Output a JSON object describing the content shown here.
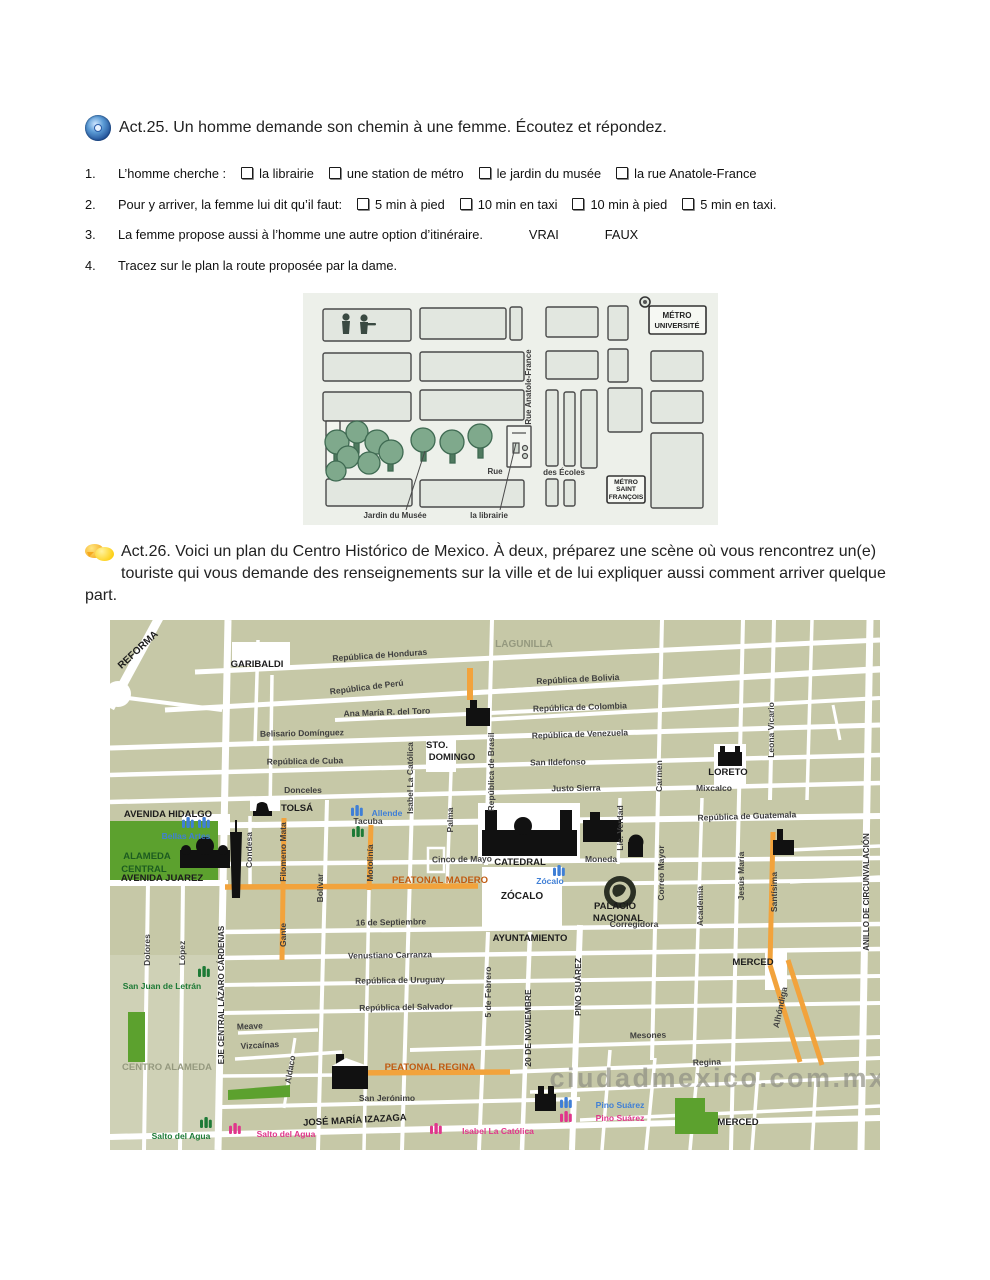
{
  "colors": {
    "map_bg": "#c6c8a7",
    "map_bg_light": "#cfd1b6",
    "street_white": "#ffffff",
    "orange_street": "#f2a33c",
    "park_green": "#5ca12e",
    "metro_blue": "#3f7fd6",
    "metro_pink": "#e0368c",
    "metro_green": "#1d7a36",
    "peatonal_label": "#c05a10",
    "watermark_grey": "#8f9084",
    "small_map_bg": "#edf0ea",
    "accent_cd_blue": "#2a5ca8",
    "accent_bubble_yellow": "#f5a81e"
  },
  "act25": {
    "icon": "audio-cd-icon",
    "title": "Act.25. Un homme demande son chemin à une femme. Écoutez et répondez.",
    "questions": [
      {
        "num": "1.",
        "text": "L’homme cherche :",
        "options": [
          "la librairie",
          "une station de métro",
          "le jardin du musée",
          "la rue Anatole-France"
        ],
        "plain": []
      },
      {
        "num": "2.",
        "text": "Pour y arriver, la femme lui dit qu’il faut:",
        "options": [
          "5 min à pied",
          "10 min en taxi",
          "10 min à pied",
          "5 min en taxi."
        ],
        "plain": []
      },
      {
        "num": "3.",
        "text": "La femme propose aussi à l’homme une autre option d’itinéraire.",
        "options": [],
        "plain": [
          "VRAI",
          "FAUX"
        ]
      },
      {
        "num": "4.",
        "text": "Tracez sur le plan la route proposée par la dame.",
        "options": [],
        "plain": []
      }
    ],
    "map_labels": [
      {
        "t": "MÉTRO",
        "x": 374,
        "y": 25,
        "s": 8,
        "c": "smb"
      },
      {
        "t": "UNIVERSITÉ",
        "x": 374,
        "y": 35,
        "s": 7.5,
        "c": "smb"
      },
      {
        "t": "Rue Anatole-France",
        "x": 228,
        "y": 94,
        "r": -90,
        "s": 8
      },
      {
        "t": "Rue",
        "x": 192,
        "y": 181,
        "s": 8
      },
      {
        "t": "des Écoles",
        "x": 261,
        "y": 182,
        "s": 8
      },
      {
        "t": "MÉTRO",
        "x": 323,
        "y": 191,
        "s": 6.6,
        "c": "smb"
      },
      {
        "t": "SAINT",
        "x": 323,
        "y": 198,
        "s": 6.6,
        "c": "smb"
      },
      {
        "t": "FRANÇOIS",
        "x": 323,
        "y": 206,
        "s": 6.6,
        "c": "smb"
      },
      {
        "t": "Jardin du Musée",
        "x": 92,
        "y": 225,
        "s": 8
      },
      {
        "t": "la librairie",
        "x": 186,
        "y": 225,
        "s": 8
      }
    ]
  },
  "act26": {
    "icon": "speech-bubbles-icon",
    "paragraph": "Act.26. Voici un plan du Centro Histórico de Mexico. À deux, préparez une scène où vous rencontrez  un(e) touriste qui vous demande des renseignements sur la ville et de lui expliquer aussi comment arriver quelque part.",
    "map": {
      "watermark": "ciudadmexico.com.mx",
      "labels": [
        {
          "t": "REFORMA",
          "x": 30,
          "y": 32,
          "r": -43,
          "c": "big",
          "s": 10
        },
        {
          "t": "GARIBALDI",
          "x": 147,
          "y": 47,
          "c": "big",
          "s": 9.5
        },
        {
          "t": "LAGUNILLA",
          "x": 414,
          "y": 27,
          "c": "area",
          "s": 10
        },
        {
          "t": "República de Honduras",
          "x": 270,
          "y": 38,
          "r": -4
        },
        {
          "t": "República de Perú",
          "x": 257,
          "y": 70,
          "r": -7
        },
        {
          "t": "Ana María R. del Toro",
          "x": 277,
          "y": 95,
          "r": -2
        },
        {
          "t": "República de Bolivia",
          "x": 468,
          "y": 62,
          "r": -3
        },
        {
          "t": "República de Colombia",
          "x": 470,
          "y": 90,
          "r": -2
        },
        {
          "t": "República de Venezuela",
          "x": 470,
          "y": 117,
          "r": -2
        },
        {
          "t": "Belisario Domínguez",
          "x": 192,
          "y": 116,
          "r": -1
        },
        {
          "t": "República de Cuba",
          "x": 195,
          "y": 144,
          "r": -1
        },
        {
          "t": "San Ildefonso",
          "x": 448,
          "y": 145,
          "r": -1
        },
        {
          "t": "Donceles",
          "x": 193,
          "y": 173
        },
        {
          "t": "Justo Sierra",
          "x": 466,
          "y": 171,
          "r": -1
        },
        {
          "t": "Mixcalco",
          "x": 604,
          "y": 171
        },
        {
          "t": "STO.",
          "x": 327,
          "y": 128,
          "c": "big",
          "s": 9.5
        },
        {
          "t": "DOMINGO",
          "x": 342,
          "y": 140,
          "c": "big",
          "s": 9.5
        },
        {
          "t": "LORETO",
          "x": 618,
          "y": 155,
          "c": "big",
          "s": 9.5
        },
        {
          "t": "República de Guatemala",
          "x": 637,
          "y": 199,
          "r": -2
        },
        {
          "t": "AVENIDA HIDALGO",
          "x": 58,
          "y": 197,
          "c": "big",
          "s": 9.5,
          "a": "middle"
        },
        {
          "t": "Tacuba",
          "x": 258,
          "y": 204
        },
        {
          "t": "TOLSÁ",
          "x": 187,
          "y": 191,
          "c": "big",
          "s": 9.5
        },
        {
          "t": "Bellas Artes",
          "x": 76,
          "y": 219,
          "c": "blue"
        },
        {
          "t": "ALAMEDA",
          "x": 37,
          "y": 239,
          "c": "greenDark",
          "s": 9.5
        },
        {
          "t": "CENTRAL",
          "x": 34,
          "y": 252,
          "c": "greenDark",
          "s": 9.5
        },
        {
          "t": "AVENIDA JUAREZ",
          "x": 52,
          "y": 261,
          "c": "big",
          "s": 9.5
        },
        {
          "t": "Allende",
          "x": 277,
          "y": 196,
          "c": "blue"
        },
        {
          "t": "Cinco de Mayo",
          "x": 352,
          "y": 242,
          "r": -1
        },
        {
          "t": "Moneda",
          "x": 491,
          "y": 242
        },
        {
          "t": "PEATONAL MADERO",
          "x": 330,
          "y": 263,
          "c": "peat",
          "s": 9.5
        },
        {
          "t": "Zócalo",
          "x": 440,
          "y": 264,
          "c": "blue"
        },
        {
          "t": "ZÓCALO",
          "x": 412,
          "y": 279,
          "c": "big",
          "s": 10
        },
        {
          "t": "CATEDRAL",
          "x": 410,
          "y": 245,
          "c": "big",
          "s": 9.5
        },
        {
          "t": "PALACIO",
          "x": 505,
          "y": 289,
          "c": "big",
          "s": 9.5
        },
        {
          "t": "NACIONAL",
          "x": 508,
          "y": 301,
          "c": "big",
          "s": 9.5
        },
        {
          "t": "Corregidora",
          "x": 524,
          "y": 307
        },
        {
          "t": "16 de Septiembre",
          "x": 281,
          "y": 305,
          "r": -1
        },
        {
          "t": "AYUNTAMIENTO",
          "x": 420,
          "y": 321,
          "c": "big",
          "s": 9.5
        },
        {
          "t": "Venustiano Carranza",
          "x": 280,
          "y": 338,
          "r": -1
        },
        {
          "t": "MERCED",
          "x": 643,
          "y": 345,
          "c": "big",
          "s": 9.5
        },
        {
          "t": "República de Uruguay",
          "x": 290,
          "y": 363,
          "r": -1
        },
        {
          "t": "República del Salvador",
          "x": 296,
          "y": 390,
          "r": -1
        },
        {
          "t": "Meave",
          "x": 140,
          "y": 409,
          "r": -3
        },
        {
          "t": "Vizcaínas",
          "x": 150,
          "y": 428,
          "r": -3
        },
        {
          "t": "Mesones",
          "x": 538,
          "y": 418,
          "r": -1
        },
        {
          "t": "CENTRO ALAMEDA",
          "x": 57,
          "y": 450,
          "c": "area",
          "s": 9.5
        },
        {
          "t": "PEATONAL REGINA",
          "x": 320,
          "y": 450,
          "c": "peat",
          "s": 9.5
        },
        {
          "t": "Regina",
          "x": 597,
          "y": 445,
          "r": -2
        },
        {
          "t": "San Jerónimo",
          "x": 277,
          "y": 481
        },
        {
          "t": "JOSÉ MARÍA IZAZAGA",
          "x": 245,
          "y": 503,
          "r": -3,
          "c": "big",
          "s": 9.5
        },
        {
          "t": "MERCED",
          "x": 628,
          "y": 505,
          "c": "big",
          "s": 9.5
        },
        {
          "t": "San Juan de Letrán",
          "x": 52,
          "y": 369,
          "c": "green"
        },
        {
          "t": "Salto del Agua",
          "x": 71,
          "y": 519,
          "c": "green"
        },
        {
          "t": "Salto del Agua",
          "x": 176,
          "y": 517,
          "c": "pink"
        },
        {
          "t": "Isabel La Católica",
          "x": 388,
          "y": 514,
          "c": "pink"
        },
        {
          "t": "Pino Suárez",
          "x": 510,
          "y": 488,
          "c": "blue"
        },
        {
          "t": "Pino Suárez",
          "x": 510,
          "y": 501,
          "c": "pink"
        },
        {
          "t": "Dolores",
          "x": 40,
          "y": 330,
          "r": -90
        },
        {
          "t": "López",
          "x": 75,
          "y": 333,
          "r": -90
        },
        {
          "t": "EJE CENTRAL LÁZARO CÁRDENAS",
          "x": 114,
          "y": 375,
          "r": -90,
          "c": "stb",
          "s": 8
        },
        {
          "t": "Condesa",
          "x": 142,
          "y": 230,
          "r": -90
        },
        {
          "t": "Filomeno Mata",
          "x": 176,
          "y": 232,
          "r": -90
        },
        {
          "t": "Gante",
          "x": 176,
          "y": 315,
          "r": -90
        },
        {
          "t": "Bolívar",
          "x": 213,
          "y": 268,
          "r": -90
        },
        {
          "t": "Motolinía",
          "x": 263,
          "y": 243,
          "r": -90
        },
        {
          "t": "Isabel La Católica",
          "x": 303,
          "y": 158,
          "r": -90
        },
        {
          "t": "Palma",
          "x": 343,
          "y": 200,
          "r": -90
        },
        {
          "t": "República de Brasil",
          "x": 384,
          "y": 152,
          "r": -90
        },
        {
          "t": "5 de Febrero",
          "x": 381,
          "y": 372,
          "r": -90
        },
        {
          "t": "20 DE NOVIEMBRE",
          "x": 421,
          "y": 408,
          "r": -90,
          "c": "stb"
        },
        {
          "t": "PINO SUÁREZ",
          "x": 471,
          "y": 367,
          "r": -90,
          "c": "stb"
        },
        {
          "t": "Lic. Verdad",
          "x": 513,
          "y": 208,
          "r": -90
        },
        {
          "t": "Carmen",
          "x": 552,
          "y": 156,
          "r": -90
        },
        {
          "t": "Correo Mayor",
          "x": 554,
          "y": 253,
          "r": -90
        },
        {
          "t": "Academia",
          "x": 593,
          "y": 286,
          "r": -90
        },
        {
          "t": "Jesús María",
          "x": 634,
          "y": 256,
          "r": -90
        },
        {
          "t": "Leona Vicario",
          "x": 664,
          "y": 110,
          "r": -90
        },
        {
          "t": "Santísima",
          "x": 667,
          "y": 272,
          "r": -90
        },
        {
          "t": "Alhóndiga",
          "x": 673,
          "y": 388,
          "r": -78
        },
        {
          "t": "ANILLO DE CIRCUNVALACIÓN",
          "x": 759,
          "y": 272,
          "r": -90,
          "c": "stb",
          "s": 8
        },
        {
          "t": "Aldaco",
          "x": 183,
          "y": 450,
          "r": -80
        },
        {
          "t": "ciudadmexico.com.mx",
          "x": 608,
          "y": 467,
          "c": "wm",
          "s": 27
        }
      ],
      "metro_icons": [
        {
          "c": "blue",
          "x": 72,
          "y": 197
        },
        {
          "c": "blue",
          "x": 88,
          "y": 197
        },
        {
          "c": "blue",
          "x": 241,
          "y": 185
        },
        {
          "c": "green",
          "x": 242,
          "y": 206
        },
        {
          "c": "blue",
          "x": 443,
          "y": 245
        },
        {
          "c": "green",
          "x": 88,
          "y": 346
        },
        {
          "c": "green",
          "x": 90,
          "y": 497
        },
        {
          "c": "pink",
          "x": 119,
          "y": 503
        },
        {
          "c": "pink",
          "x": 320,
          "y": 503
        },
        {
          "c": "blue",
          "x": 450,
          "y": 477
        },
        {
          "c": "pink",
          "x": 450,
          "y": 491
        }
      ]
    }
  }
}
